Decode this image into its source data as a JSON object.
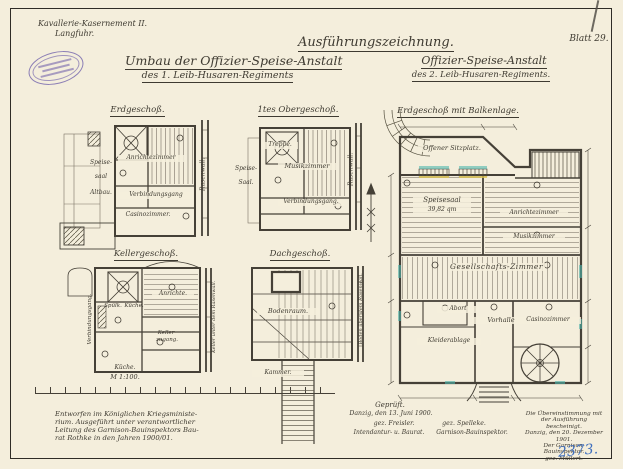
{
  "sheet": {
    "site_line1": "Kavallerie-Kasernement II.",
    "site_line2": "Langfuhr.",
    "doc_type": "Ausführungszeichnung.",
    "blatt": "Blatt 29.",
    "left_title": "Umbau der Offizier-Speise-Anstalt",
    "left_subtitle": "des 1. Leib-Husaren-Regiments",
    "right_title": "Offizier-Speise-Anstalt",
    "right_subtitle": "des 2. Leib-Husaren-Regiments.",
    "scale_label": "M 1:100.",
    "inventory_no": "2373."
  },
  "plans": {
    "erdgeschoss": {
      "title": "Erdgeschoß.",
      "speise1": "Speise-",
      "speise2": "saal",
      "speise3": "Altbau.",
      "anrichte": "Anrichtezimmer",
      "gang": "Verbindungsgang",
      "casino": "Casinozimmer.",
      "side": "Rasenwall."
    },
    "obergeschoss": {
      "title": "1tes Obergeschoß.",
      "treppe": "Treppe.",
      "musik": "Musikzimmer",
      "speise1": "Speise-",
      "speise2": "Saal.",
      "gang": "Verbindungsgang.",
      "side": "Rasenwall."
    },
    "keller": {
      "title": "Kellergeschoß.",
      "spuelk": "Spülk.",
      "kueche": "Küche.",
      "anrichte": "Anrichte.",
      "zugang1": "Keller-",
      "zugang2": "zugang.",
      "gang": "Verbindungsgang.",
      "side": "Keller unter dem Rasenwall.",
      "kueche2": "Küche."
    },
    "dach": {
      "title": "Dachgeschoß.",
      "boden": "Bodenraum.",
      "kammer": "Kammer.",
      "side": "Boden über dem Rasenwall."
    },
    "balkenlage": {
      "title": "Erdgeschoß mit Balkenlage.",
      "sitzplatz": "Offener Sitzplatz.",
      "speisesaal": "Speisesaal",
      "speisesaal_qm": "39,82 qm",
      "anrichte": "Anrichtezimmer",
      "musik": "Musikzimmer",
      "gesellschaft": "Gesellschafts-Zimmer",
      "abort": "Abort",
      "kleider": "Kleiderablage",
      "vorhalle": "Vorhalle",
      "casino": "Casinozimmer"
    }
  },
  "notes": {
    "designed1": "Entworfen im Königlichen Kriegsministe-",
    "designed2": "rium. Ausgeführt unter verantwortlicher",
    "designed3": "Leitung des Garnison-Bauinspektors Bau-",
    "designed4": "rat Rothke in den Jahren 1900/01.",
    "checked_heading": "Geprüft.",
    "checked_date": "Danzig, den 13. Juni 1900.",
    "sig_left": "gez. Freisler.",
    "sig_right": "gez. Spelleke.",
    "role_left": "Intendantur- u. Baurat.",
    "role_right": "Garnison-Bauinspektor.",
    "cert1": "Die Übereinstimmung mit",
    "cert2": "der Ausführung bescheinigt.",
    "cert3": "Danzig, den 20. Dezember 1901.",
    "cert4": "Der Garnison-Bauinspektor.",
    "cert5": "gez. Müllert."
  },
  "colors": {
    "paper": "#f4eedc",
    "ink": "#454037",
    "stamp_purple": "#6858a8",
    "inventory_blue": "#3f6fbe",
    "window_teal": "#4fb8ae",
    "door_yellow": "#dec44e"
  }
}
